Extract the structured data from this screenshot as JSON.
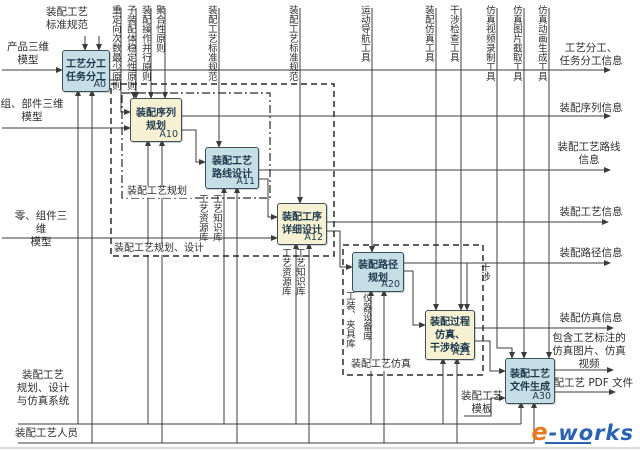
{
  "diagram": {
    "colors": {
      "box_blue": "#c6dee6",
      "box_yellow": "#f6f1d3",
      "line": "#3c3c3c",
      "logo_orange": "#e87a1e",
      "logo_blue": "#2a63ae"
    },
    "boxes": [
      {
        "n": "activity-A0",
        "tag": "A0",
        "t": "工艺分工\n任务分工",
        "x": 62,
        "y": 50,
        "w": 46,
        "h": 40,
        "fill": "box_blue"
      },
      {
        "n": "activity-A10",
        "tag": "A10",
        "t": "装配序列\n规划",
        "x": 130,
        "y": 98,
        "w": 50,
        "h": 42,
        "fill": "box_yellow"
      },
      {
        "n": "activity-A11",
        "tag": "A11",
        "t": "装配工艺\n路线设计",
        "x": 205,
        "y": 147,
        "w": 52,
        "h": 40,
        "fill": "box_blue"
      },
      {
        "n": "activity-A12",
        "tag": "A12",
        "t": "装配工序\n详细设计",
        "x": 277,
        "y": 203,
        "w": 48,
        "h": 40,
        "fill": "box_yellow"
      },
      {
        "n": "activity-A20",
        "tag": "A20",
        "t": "装配路径\n规划",
        "x": 352,
        "y": 252,
        "w": 50,
        "h": 38,
        "fill": "box_blue"
      },
      {
        "n": "activity-A21",
        "tag": "A21",
        "t": "装配过程\n仿真、\n干涉检查",
        "x": 425,
        "y": 310,
        "w": 48,
        "h": 48,
        "fill": "box_yellow"
      },
      {
        "n": "activity-A30",
        "tag": "A30",
        "t": "装配工艺\n文件生成",
        "x": 505,
        "y": 358,
        "w": 48,
        "h": 44,
        "fill": "box_blue"
      }
    ],
    "groups": [
      {
        "n": "group-process-planning",
        "x": 122,
        "y": 93,
        "w": 148,
        "h": 105,
        "style": "dashdot"
      },
      {
        "n": "group-planning-design",
        "x": 111,
        "y": 84,
        "w": 223,
        "h": 172,
        "style": "dashed"
      },
      {
        "n": "group-process-simulation",
        "x": 343,
        "y": 245,
        "w": 140,
        "h": 130,
        "style": "dashed"
      }
    ],
    "labels": [
      {
        "n": "control-std-spec-a0",
        "t": "装配工艺\n标准规范",
        "x": 40,
        "y": 6,
        "w": 54,
        "a": "center"
      },
      {
        "n": "input-product-3d-model",
        "t": "产品三维\n模型",
        "x": 2,
        "y": 41,
        "w": 52,
        "a": "center"
      },
      {
        "n": "input-assembly-part-3d-model",
        "t": "组、部件三维\n模型",
        "x": 0,
        "y": 98,
        "w": 64,
        "a": "center"
      },
      {
        "n": "input-component-3d-model",
        "t": "零、组件三维\n模型",
        "x": 10,
        "y": 210,
        "w": 62,
        "a": "center"
      },
      {
        "n": "group-label-process-planning",
        "t": "装配工艺规划",
        "x": 126,
        "y": 186,
        "w": 64,
        "a": "left",
        "g": 1
      },
      {
        "n": "group-label-planning-design",
        "t": "装配工艺规划、设计",
        "x": 113,
        "y": 243,
        "w": 96,
        "a": "left",
        "g": 1
      },
      {
        "n": "group-label-simulation",
        "t": "装配工艺仿真",
        "x": 350,
        "y": 359,
        "w": 66,
        "a": "left",
        "g": 1
      },
      {
        "n": "output-task-division-info",
        "t": "工艺分工、\n任务分工信息",
        "x": 546,
        "y": 42,
        "w": 90,
        "a": "center"
      },
      {
        "n": "output-sequence-info",
        "t": "装配序列信息",
        "x": 550,
        "y": 102,
        "w": 82,
        "a": "center"
      },
      {
        "n": "output-route-info",
        "t": "装配工艺路线\n信息",
        "x": 548,
        "y": 141,
        "w": 82,
        "a": "center"
      },
      {
        "n": "output-process-info",
        "t": "装配工艺信息",
        "x": 550,
        "y": 206,
        "w": 82,
        "a": "center"
      },
      {
        "n": "output-path-info",
        "t": "装配路径信息",
        "x": 550,
        "y": 247,
        "w": 82,
        "a": "center"
      },
      {
        "n": "output-simulation-info",
        "t": "装配仿真信息",
        "x": 550,
        "y": 312,
        "w": 82,
        "a": "center"
      },
      {
        "n": "output-annotated-media",
        "t": "包含工艺标注的\n仿真图片、仿真\n视频",
        "x": 543,
        "y": 332,
        "w": 92,
        "a": "center"
      },
      {
        "n": "output-pdf-file",
        "t": "装配工艺 PDF 文件",
        "x": 543,
        "y": 377,
        "w": 96,
        "a": "left"
      },
      {
        "n": "mech-template",
        "t": "装配工艺\n模板",
        "x": 460,
        "y": 390,
        "w": 44,
        "a": "center"
      },
      {
        "n": "mech-system",
        "t": "装配工艺\n规划、设计\n与仿真系统",
        "x": 12,
        "y": 369,
        "w": 62,
        "a": "center"
      },
      {
        "n": "mech-personnel",
        "t": "装配工艺人员",
        "x": 15,
        "y": 427,
        "w": 66,
        "a": "left"
      },
      {
        "n": "ctrl-min-reorientation",
        "t": "重定向次数最少原则",
        "x": 109,
        "y": 5,
        "o": "v"
      },
      {
        "n": "ctrl-subassembly-stability",
        "t": "子装配体稳定性原则",
        "x": 124,
        "y": 5,
        "o": "v"
      },
      {
        "n": "ctrl-parallel-operation",
        "t": "装配操作并行原则",
        "x": 139,
        "y": 5,
        "o": "v"
      },
      {
        "n": "ctrl-aggregation",
        "t": "聚合性原则",
        "x": 153,
        "y": 5,
        "o": "v"
      },
      {
        "n": "ctrl-std-spec-a11",
        "t": "装配工艺标准规范",
        "x": 205,
        "y": 5,
        "o": "v"
      },
      {
        "n": "ctrl-std-spec-a12",
        "t": "装配工艺标准规范",
        "x": 286,
        "y": 5,
        "o": "v"
      },
      {
        "n": "ctrl-motion-nav-tool",
        "t": "运动导航工具",
        "x": 358,
        "y": 5,
        "o": "v"
      },
      {
        "n": "ctrl-assembly-sim-tool",
        "t": "装配仿真工具",
        "x": 422,
        "y": 5,
        "o": "v"
      },
      {
        "n": "ctrl-interference-check-tool",
        "t": "干涉检查工具",
        "x": 447,
        "y": 5,
        "o": "v"
      },
      {
        "n": "ctrl-sim-video-tool",
        "t": "仿真视频录制工具",
        "x": 483,
        "y": 5,
        "o": "v"
      },
      {
        "n": "ctrl-sim-image-tool",
        "t": "仿真图片截取工具",
        "x": 510,
        "y": 5,
        "o": "v"
      },
      {
        "n": "ctrl-sim-animation-tool",
        "t": "仿真动画生成工具",
        "x": 535,
        "y": 5,
        "o": "v"
      },
      {
        "n": "mech-resource-lib-a11",
        "t": "工艺资源库",
        "x": 196,
        "y": 194,
        "o": "v"
      },
      {
        "n": "mech-knowledge-lib-a11",
        "t": "工艺知识库",
        "x": 210,
        "y": 194,
        "o": "v"
      },
      {
        "n": "mech-resource-lib-a12",
        "t": "工艺资源库",
        "x": 279,
        "y": 248,
        "o": "v"
      },
      {
        "n": "mech-knowledge-lib-a12",
        "t": "工艺知识库",
        "x": 293,
        "y": 248,
        "o": "v"
      },
      {
        "n": "mech-fixture-lib",
        "t": "工装、夹具库",
        "x": 343,
        "y": 291,
        "o": "v"
      },
      {
        "n": "mech-equipment-lib",
        "t": "仪器设备库",
        "x": 360,
        "y": 293,
        "o": "v"
      },
      {
        "n": "label-interference",
        "t": "干涉",
        "x": 478,
        "y": 262,
        "o": "v"
      }
    ],
    "lines": [
      {
        "n": "input-product-line",
        "pts": [
          [
            2,
            70
          ],
          [
            62,
            70
          ]
        ],
        "arrow": true
      },
      {
        "n": "input-assembly-line",
        "pts": [
          [
            2,
            128
          ],
          [
            130,
            128
          ]
        ],
        "arrow": true
      },
      {
        "n": "input-component-line",
        "pts": [
          [
            2,
            238
          ],
          [
            277,
            238
          ]
        ],
        "arrow": true
      },
      {
        "n": "output-task-division-line",
        "pts": [
          [
            108,
            70
          ],
          [
            610,
            70
          ]
        ],
        "arrow": true
      },
      {
        "n": "output-sequence-line",
        "pts": [
          [
            180,
            116
          ],
          [
            610,
            116
          ]
        ],
        "arrow": true
      },
      {
        "n": "output-route-line",
        "pts": [
          [
            257,
            170
          ],
          [
            610,
            170
          ]
        ],
        "arrow": true
      },
      {
        "n": "output-process-line",
        "pts": [
          [
            325,
            222
          ],
          [
            608,
            222
          ]
        ],
        "arrow": true
      },
      {
        "n": "output-path-line",
        "pts": [
          [
            402,
            263
          ],
          [
            610,
            263
          ]
        ],
        "arrow": true
      },
      {
        "n": "output-sim-line",
        "pts": [
          [
            473,
            328
          ],
          [
            613,
            328
          ]
        ],
        "arrow": true
      },
      {
        "n": "output-media-line",
        "pts": [
          [
            553,
            370
          ],
          [
            613,
            370
          ]
        ],
        "arrow": true
      },
      {
        "n": "output-pdf-line",
        "pts": [
          [
            553,
            392
          ],
          [
            615,
            392
          ]
        ],
        "arrow": true
      },
      {
        "n": "ctrl-a0-line-1",
        "pts": [
          [
            85,
            36
          ],
          [
            85,
            50
          ]
        ],
        "arrow": true
      },
      {
        "n": "ctrl-a0-line-2",
        "pts": [
          [
            99,
            36
          ],
          [
            99,
            50
          ]
        ],
        "arrow": true
      },
      {
        "n": "ctrl-principle-line-1",
        "pts": [
          [
            121,
            8
          ],
          [
            121,
            93
          ],
          [
            134,
            93
          ],
          [
            134,
            98
          ]
        ],
        "arrow": true
      },
      {
        "n": "ctrl-principle-line-2",
        "pts": [
          [
            136,
            8
          ],
          [
            136,
            98
          ]
        ],
        "arrow": true
      },
      {
        "n": "ctrl-principle-line-3",
        "pts": [
          [
            151,
            8
          ],
          [
            151,
            98
          ]
        ],
        "arrow": true
      },
      {
        "n": "ctrl-principle-line-4",
        "pts": [
          [
            165,
            8
          ],
          [
            165,
            98
          ]
        ],
        "arrow": true
      },
      {
        "n": "ctrl-stdspec-a11-line",
        "pts": [
          [
            219,
            8
          ],
          [
            219,
            147
          ]
        ],
        "arrow": true
      },
      {
        "n": "ctrl-stdspec-a12-line",
        "pts": [
          [
            300,
            8
          ],
          [
            300,
            203
          ]
        ],
        "arrow": true
      },
      {
        "n": "ctrl-motion-nav-line",
        "pts": [
          [
            372,
            8
          ],
          [
            372,
            252
          ]
        ],
        "arrow": true
      },
      {
        "n": "ctrl-sim-tool-line",
        "pts": [
          [
            436,
            8
          ],
          [
            436,
            310
          ]
        ],
        "arrow": true
      },
      {
        "n": "ctrl-interference-tool-line",
        "pts": [
          [
            461,
            8
          ],
          [
            461,
            310
          ]
        ],
        "arrow": true
      },
      {
        "n": "ctrl-video-tool-line",
        "pts": [
          [
            497,
            8
          ],
          [
            497,
            348
          ],
          [
            512,
            348
          ],
          [
            512,
            358
          ]
        ],
        "arrow": true
      },
      {
        "n": "ctrl-image-tool-line",
        "pts": [
          [
            524,
            8
          ],
          [
            524,
            358
          ]
        ],
        "arrow": true
      },
      {
        "n": "ctrl-animation-tool-line",
        "pts": [
          [
            549,
            8
          ],
          [
            549,
            358
          ]
        ],
        "arrow": true
      },
      {
        "n": "connector-a0-a10",
        "pts": [
          [
            108,
            80
          ],
          [
            121,
            80
          ],
          [
            121,
            112
          ],
          [
            130,
            112
          ]
        ],
        "arrow": true
      },
      {
        "n": "connector-a10-a11",
        "pts": [
          [
            180,
            130
          ],
          [
            196,
            130
          ],
          [
            196,
            162
          ],
          [
            205,
            162
          ]
        ],
        "arrow": true
      },
      {
        "n": "connector-a11-a12",
        "pts": [
          [
            257,
            179
          ],
          [
            268,
            179
          ],
          [
            268,
            217
          ],
          [
            277,
            217
          ]
        ],
        "arrow": true
      },
      {
        "n": "connector-a12-a20",
        "pts": [
          [
            325,
            231
          ],
          [
            340,
            231
          ],
          [
            340,
            267
          ],
          [
            352,
            267
          ]
        ],
        "arrow": true
      },
      {
        "n": "connector-a20-a21",
        "pts": [
          [
            402,
            271
          ],
          [
            413,
            271
          ],
          [
            413,
            325
          ],
          [
            425,
            325
          ]
        ],
        "arrow": true
      },
      {
        "n": "connector-a21-a30",
        "pts": [
          [
            473,
            341
          ],
          [
            490,
            341
          ],
          [
            490,
            371
          ],
          [
            505,
            371
          ]
        ],
        "arrow": true
      },
      {
        "n": "interference-branch",
        "pts": [
          [
            467,
            263
          ],
          [
            467,
            310
          ]
        ],
        "arrow": true
      },
      {
        "n": "template-line",
        "pts": [
          [
            464,
            416
          ],
          [
            491,
            416
          ],
          [
            491,
            398
          ],
          [
            505,
            398
          ]
        ],
        "arrow": true
      },
      {
        "n": "mech-riser-a0-1",
        "pts": [
          [
            78,
            424
          ],
          [
            78,
            90
          ]
        ],
        "arrow": true
      },
      {
        "n": "mech-riser-a10-1",
        "pts": [
          [
            148,
            424
          ],
          [
            148,
            140
          ]
        ],
        "arrow": true
      },
      {
        "n": "mech-riser-a11-1",
        "pts": [
          [
            224,
            424
          ],
          [
            224,
            187
          ]
        ],
        "arrow": true
      },
      {
        "n": "mech-riser-a12-1",
        "pts": [
          [
            296,
            424
          ],
          [
            296,
            243
          ]
        ],
        "arrow": true
      },
      {
        "n": "mech-riser-a20-1",
        "pts": [
          [
            371,
            424
          ],
          [
            371,
            290
          ]
        ],
        "arrow": true
      },
      {
        "n": "mech-riser-a21-1",
        "pts": [
          [
            443,
            424
          ],
          [
            443,
            358
          ]
        ],
        "arrow": true
      },
      {
        "n": "mech-riser-a30-1",
        "pts": [
          [
            521,
            424
          ],
          [
            521,
            402
          ]
        ],
        "arrow": true
      },
      {
        "n": "mech-riser-a0-2",
        "pts": [
          [
            92,
            443
          ],
          [
            92,
            90
          ]
        ],
        "arrow": true
      },
      {
        "n": "mech-riser-a10-2",
        "pts": [
          [
            162,
            443
          ],
          [
            162,
            140
          ]
        ],
        "arrow": true
      },
      {
        "n": "mech-riser-a11-2",
        "pts": [
          [
            237,
            443
          ],
          [
            237,
            187
          ]
        ],
        "arrow": true
      },
      {
        "n": "mech-riser-a12-2",
        "pts": [
          [
            309,
            443
          ],
          [
            309,
            243
          ]
        ],
        "arrow": true
      },
      {
        "n": "mech-riser-a20-2",
        "pts": [
          [
            384,
            443
          ],
          [
            384,
            290
          ]
        ],
        "arrow": true
      },
      {
        "n": "mech-riser-a21-2",
        "pts": [
          [
            457,
            443
          ],
          [
            457,
            358
          ]
        ],
        "arrow": true
      },
      {
        "n": "mech-riser-a30-2",
        "pts": [
          [
            534,
            443
          ],
          [
            534,
            402
          ]
        ],
        "arrow": true
      },
      {
        "n": "mech-system-line",
        "pts": [
          [
            18,
            424
          ],
          [
            521,
            424
          ]
        ],
        "arrow": false
      },
      {
        "n": "mech-personnel-line",
        "pts": [
          [
            18,
            443
          ],
          [
            534,
            443
          ]
        ],
        "arrow": false
      },
      {
        "n": "image-bottom-edge",
        "pts": [
          [
            0,
            448
          ],
          [
            640,
            448
          ]
        ],
        "arrow": false,
        "style": "faint"
      }
    ],
    "logo": {
      "e": "e",
      "rest": "-works"
    }
  }
}
